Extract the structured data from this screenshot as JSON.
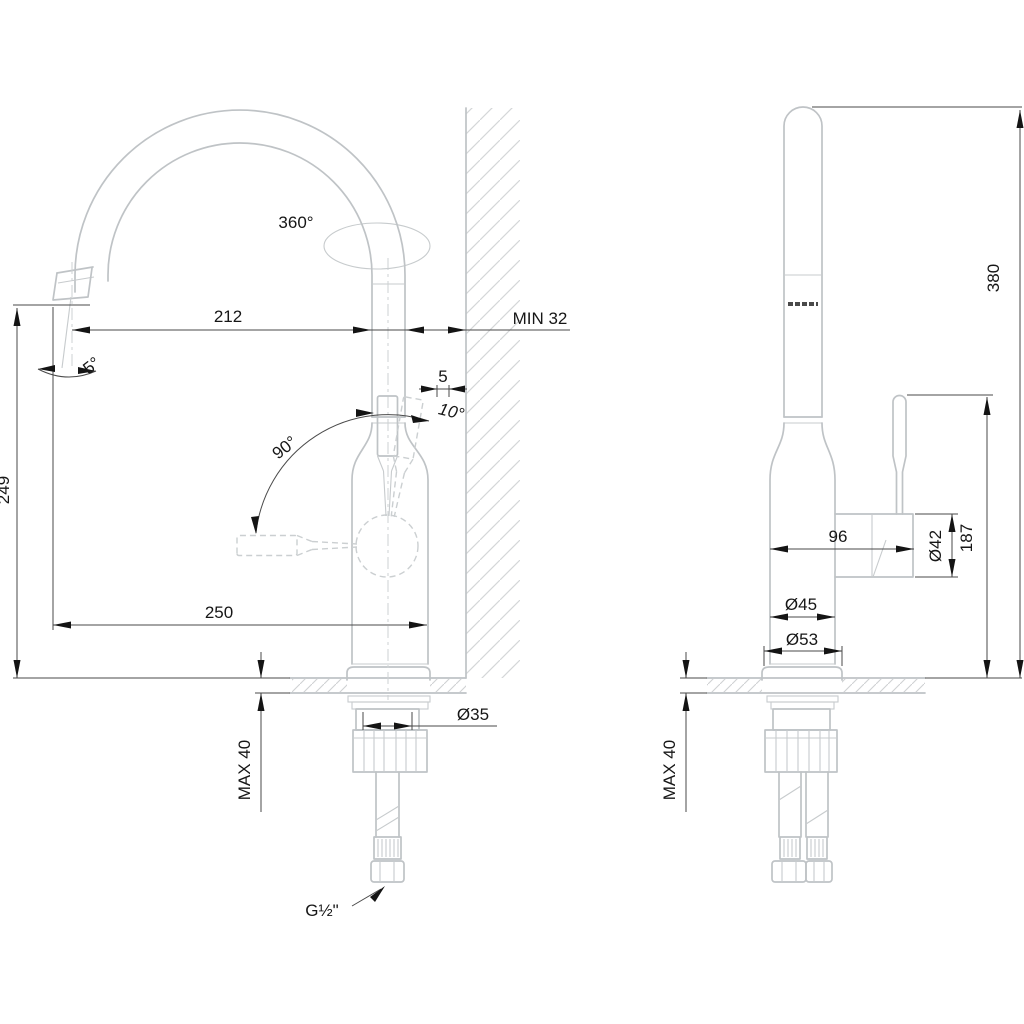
{
  "drawing_title": "kitchen mixer tap dimensional drawing, front and side views",
  "colors": {
    "background": "#ffffff",
    "product_line": "#bfc3c6",
    "hatch_line": "#d2d4d6",
    "dimension_line": "#4a4a4a",
    "annotation_ink": "#141414"
  },
  "views": {
    "front": {
      "labels": {
        "swivel_angle": "360°",
        "spout_reach": "212",
        "wall_clearance": "MIN 32",
        "spout_tilt": "5°",
        "handle_offset": "5",
        "handle_open_angle": "10°",
        "handle_swing": "90°",
        "spout_height": "249",
        "overall_reach": "250",
        "deck_max_thickness": "MAX 40",
        "shank_diameter": "Ø35",
        "supply_thread": "G½\""
      }
    },
    "side": {
      "labels": {
        "overall_height": "380",
        "body_depth": "96",
        "handle_diameter": "Ø42",
        "handle_height": "187",
        "body_diameter": "Ø45",
        "base_diameter": "Ø53",
        "deck_max_thickness": "MAX 40"
      }
    }
  }
}
